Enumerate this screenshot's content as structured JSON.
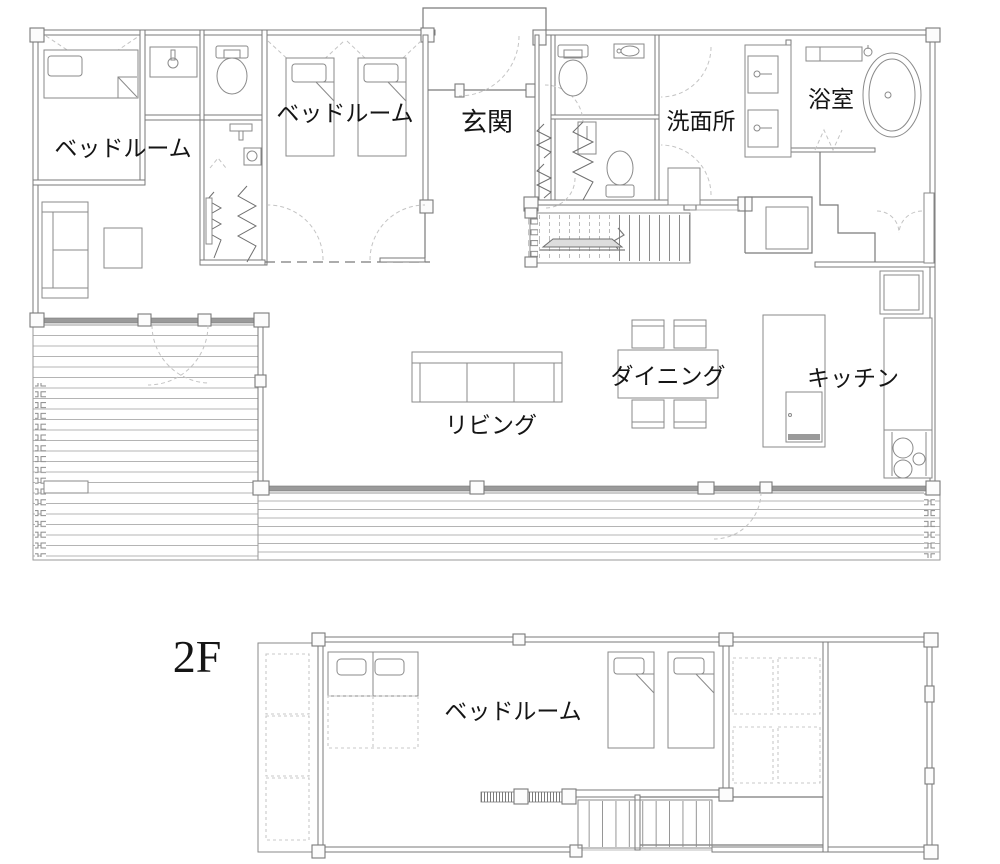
{
  "drawing": {
    "floor1": {
      "rooms": {
        "bedroom_left": "ベッドルーム",
        "bedroom_center": "ベッドルーム",
        "entrance": "玄関",
        "washroom": "洗面所",
        "bathroom": "浴室",
        "dining": "ダイニング",
        "living": "リビング",
        "kitchen": "キッチン"
      }
    },
    "floor2": {
      "floor_label": "2F",
      "rooms": {
        "bedroom": "ベッドルーム"
      }
    },
    "colors": {
      "wall_line": "#7a7a7a",
      "window_band": "#9a9a9a",
      "dashed_line": "#c4c4c4",
      "deck_line": "#b4b4b4",
      "text": "#151515",
      "background": "#ffffff"
    }
  }
}
